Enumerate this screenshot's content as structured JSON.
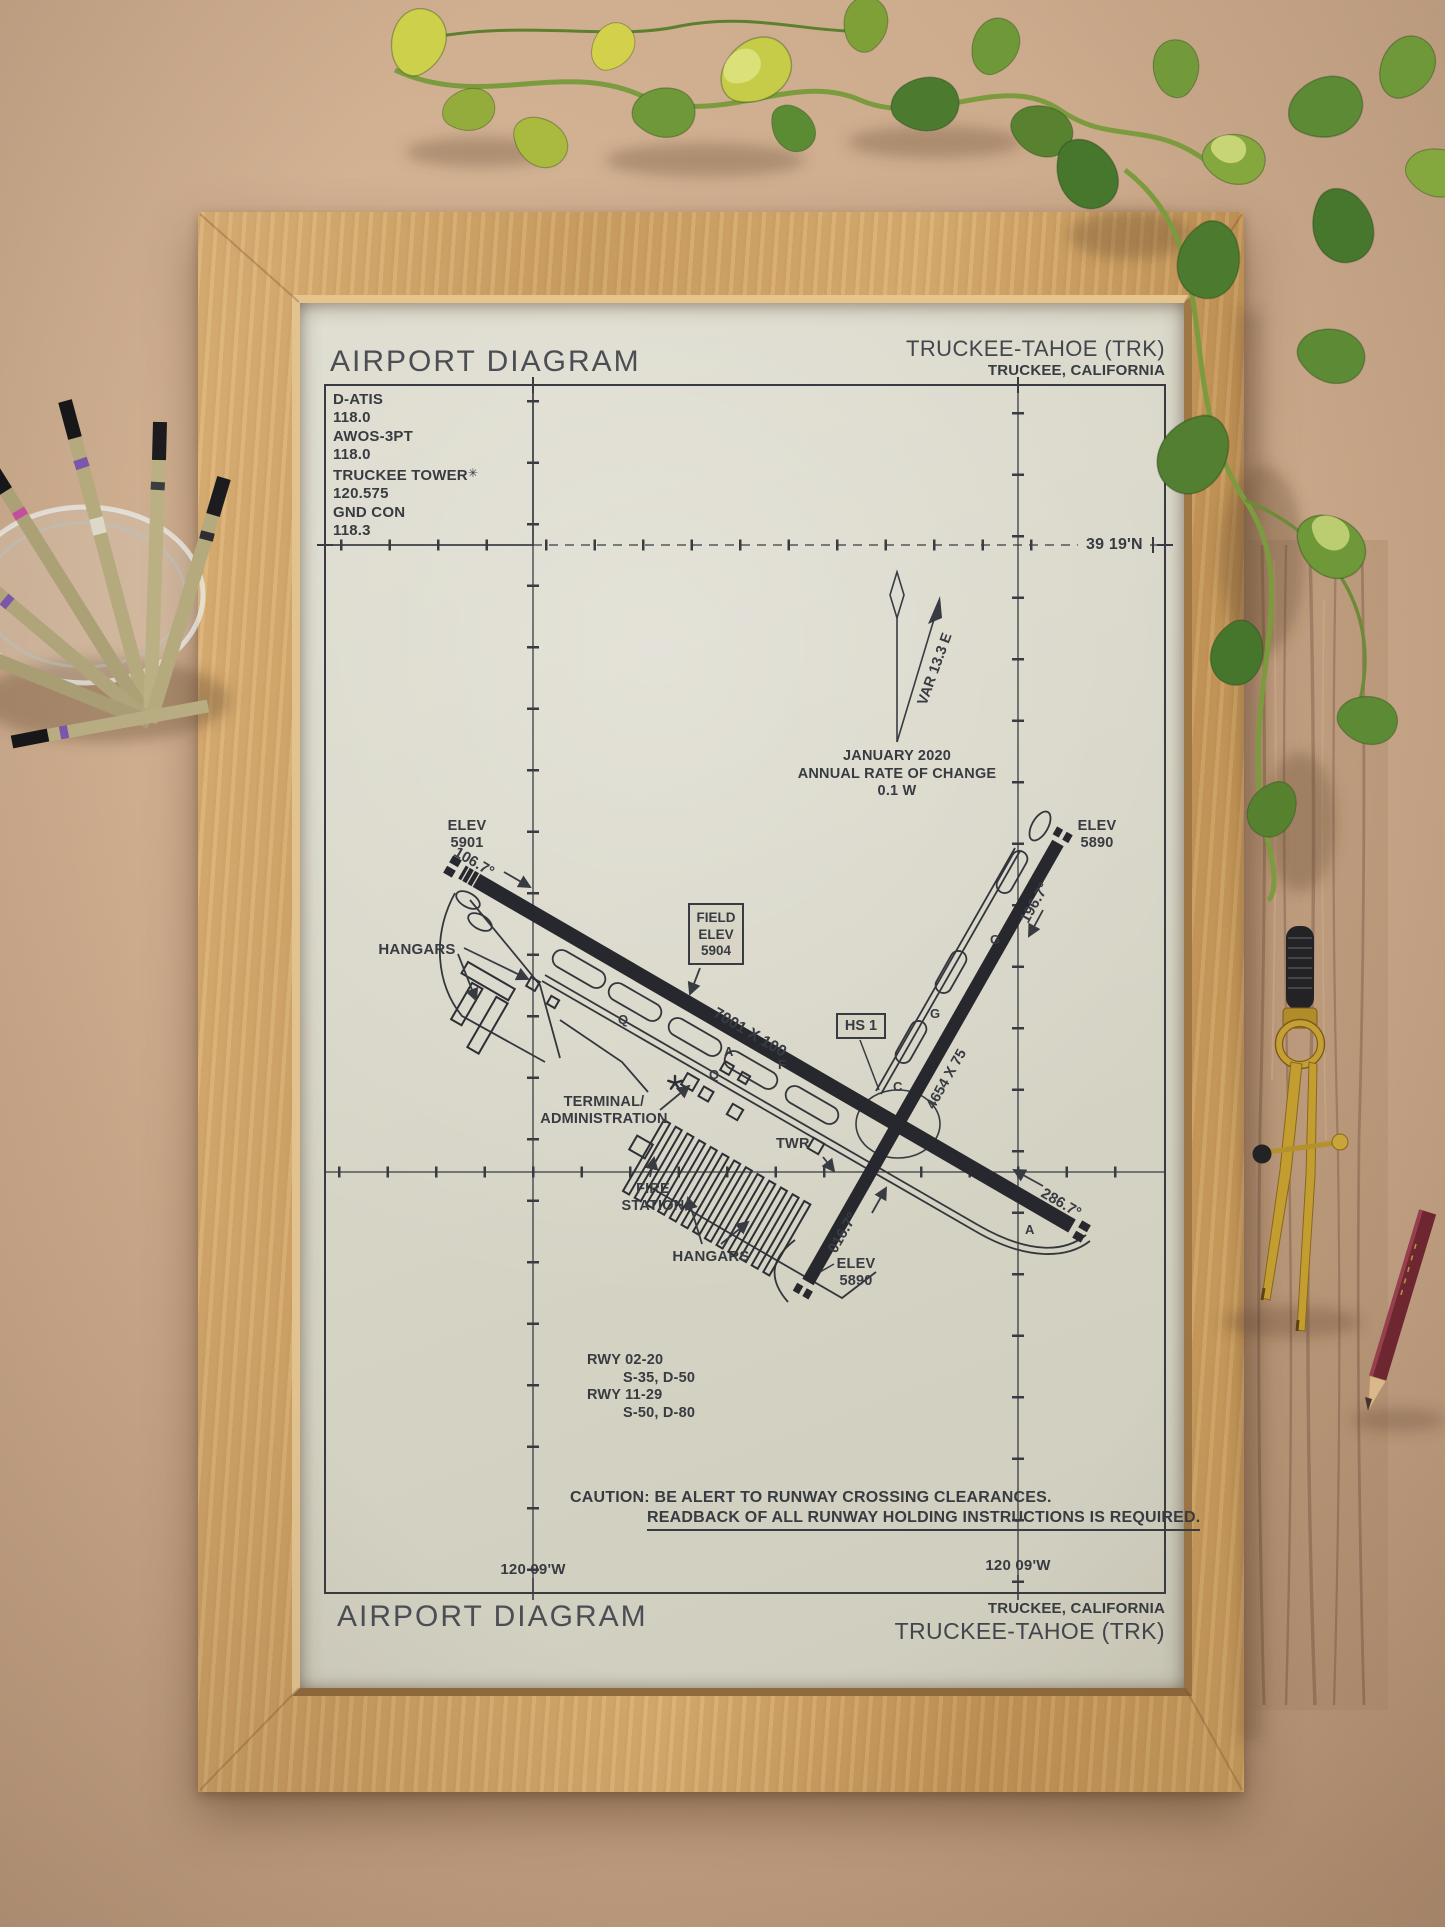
{
  "poster": {
    "header": {
      "title": "AIRPORT DIAGRAM",
      "airport": "TRUCKEE-TAHOE (TRK)",
      "city": "TRUCKEE, CALIFORNIA"
    },
    "comm": {
      "lines": [
        "D-ATIS",
        "118.0",
        "AWOS-3PT",
        "118.0",
        "TRUCKEE TOWER",
        "120.575",
        "GND CON",
        "118.3"
      ],
      "tower_star": "✳"
    },
    "grid": {
      "lat": "39 19'N",
      "lon_left": "120 09'W",
      "lon_right": "120 09'W"
    },
    "north": {
      "var": "VAR 13.3 E",
      "line1": "JANUARY 2020",
      "line2": "ANNUAL RATE OF CHANGE",
      "line3": "0.1  W"
    },
    "runways": {
      "main_dim": "7001 X 100",
      "cross_dim": "4654 X 75",
      "hdg_11": "106.7°",
      "hdg_29": "286.7°",
      "hdg_02": "016.7°",
      "hdg_20": "196.7°",
      "elev_11_l1": "ELEV",
      "elev_11_l2": "5901",
      "elev_20_l1": "ELEV",
      "elev_20_l2": "5890",
      "elev_02_l1": "ELEV",
      "elev_02_l2": "5890"
    },
    "field_elev": {
      "l1": "FIELD",
      "l2": "ELEV",
      "l3": "5904"
    },
    "hotspot": "HS 1",
    "labels": {
      "hangars_left": "HANGARS",
      "hangars_bottom": "HANGARS",
      "terminal_l1": "TERMINAL/",
      "terminal_l2": "ADMINISTRATION",
      "fire_l1": "FIRE",
      "fire_l2": "STATION",
      "twr": "TWR"
    },
    "taxiway_letters": [
      "Q",
      "A",
      "Q",
      "F",
      "G",
      "C",
      "A",
      "G"
    ],
    "data_block": [
      "RWY 02-20",
      "S-35, D-50",
      "RWY 11-29",
      "S-50, D-80"
    ],
    "caution": {
      "line1": "CAUTION: BE ALERT TO RUNWAY CROSSING CLEARANCES.",
      "line2": "READBACK OF ALL RUNWAY HOLDING INSTRUCTIONS IS REQUIRED."
    },
    "footer": {
      "title": "AIRPORT DIAGRAM",
      "city": "TRUCKEE, CALIFORNIA",
      "airport": "TRUCKEE-TAHOE (TRK)"
    }
  },
  "colors": {
    "ink": "#383c42",
    "runway": "#26282d",
    "paper": "#d9d7c8",
    "frame_wood": "#d2a567",
    "leaf_green": "#5b8c33",
    "leaf_chartreuse": "#c6cc48",
    "brass": "#c49d30"
  }
}
